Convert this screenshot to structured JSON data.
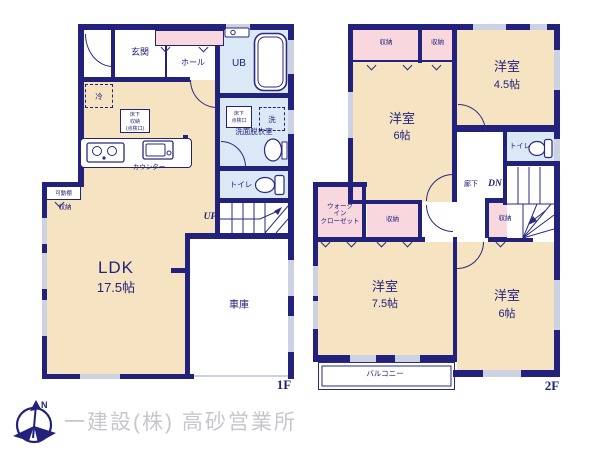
{
  "colors": {
    "wall": "#22227c",
    "room_beige": "#f5e3c2",
    "closet_pink": "#f8d8de",
    "wet_area_blue": "#dbe8f5",
    "window_gray": "#ccd2e2",
    "logo_gray": "#c6c6ce"
  },
  "floor1": {
    "label": "1F",
    "entrance": "玄関",
    "hall": "ホール",
    "unit_bath": "UB",
    "washroom": "洗面脱衣室",
    "underfloor_inspection": "床下\n点検口",
    "washer": "洗",
    "toilet": "トイレ",
    "stairs_up": "UP",
    "ldk_name": "LDK",
    "ldk_size": "17.5帖",
    "counter": "カウンター",
    "fridge": "冷",
    "underfloor_storage": "床下\n収納\n(点検口)",
    "movable_shelf": "可動棚",
    "storage": "収納",
    "garage": "車庫"
  },
  "floor2": {
    "label": "2F",
    "closet_nw_wide": "収納",
    "closet_nw_small": "収納",
    "room_nw_name": "洋室",
    "room_nw_size": "6帖",
    "room_ne_name": "洋室",
    "room_ne_size": "4.5帖",
    "toilet": "トイレ",
    "corridor": "廊下",
    "stairs_down": "DN",
    "walk_in_closet": "ウォーク\nイン\nクローゼット",
    "closet_sw": "収納",
    "closet_stair": "収納",
    "room_sw_name": "洋室",
    "room_sw_size": "7.5帖",
    "room_se_name": "洋室",
    "room_se_size": "6帖",
    "balcony": "バルコニー"
  },
  "footer": {
    "company": "一建設(株) 高砂営業所",
    "compass_north": "N"
  }
}
